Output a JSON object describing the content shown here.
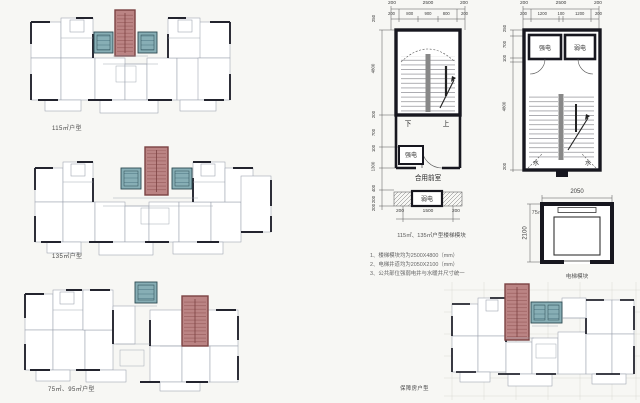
{
  "palette": {
    "core_red": "#bb8484",
    "core_red_line": "#9b5e5e",
    "teal": "#87aeb5",
    "teal_line": "#4f7a84",
    "wall_dark": "#23242e",
    "thin_line": "#9aa0ad",
    "background": "#f7f7f4"
  },
  "plans": {
    "plan_115": {
      "label": "115㎡户型"
    },
    "plan_135": {
      "label": "135㎡户型"
    },
    "plan_75_95": {
      "label": "75㎡、95㎡户型"
    },
    "plan_support": {
      "label": "保障房户型"
    }
  },
  "stair_module_a": {
    "caption": "115㎡、135㎡户型楼梯模块",
    "dims_top_outer": [
      "200",
      "2500",
      "200"
    ],
    "dims_top_inner": [
      "200",
      "800",
      "900",
      "800",
      "200"
    ],
    "dims_left": [
      "250",
      "4800",
      "200",
      "700",
      "100",
      "1300",
      "400",
      "200",
      "200"
    ],
    "dims_bottom": [
      "200",
      "1500",
      "200"
    ],
    "labels": {
      "down": "下",
      "up": "上",
      "strong_elec": "强电",
      "shared_lobby": "合用前室",
      "weak_elec": "弱电"
    }
  },
  "stair_module_b": {
    "caption": "75㎡、95㎡户型楼梯模块",
    "dims_top_outer": [
      "200",
      "2500",
      "200"
    ],
    "dims_top_inner": [
      "200",
      "1200",
      "100",
      "1200",
      "200"
    ],
    "dims_left": [
      "250",
      "700",
      "100",
      "4800",
      "200"
    ],
    "labels": {
      "strong_elec": "强电",
      "weak_elec": "弱电",
      "water_left": "水",
      "water_right": "水"
    }
  },
  "elevator_module": {
    "caption": "电梯模块",
    "dim_width": "2050",
    "dim_height": "2100"
  },
  "notes": {
    "line1": "1、楼梯模块均为2500X4800（mm）",
    "line2": "2、电梯井道均为2050X2100（mm）",
    "line3": "3、公共部位强弱电井与水暖井尺寸统一"
  }
}
